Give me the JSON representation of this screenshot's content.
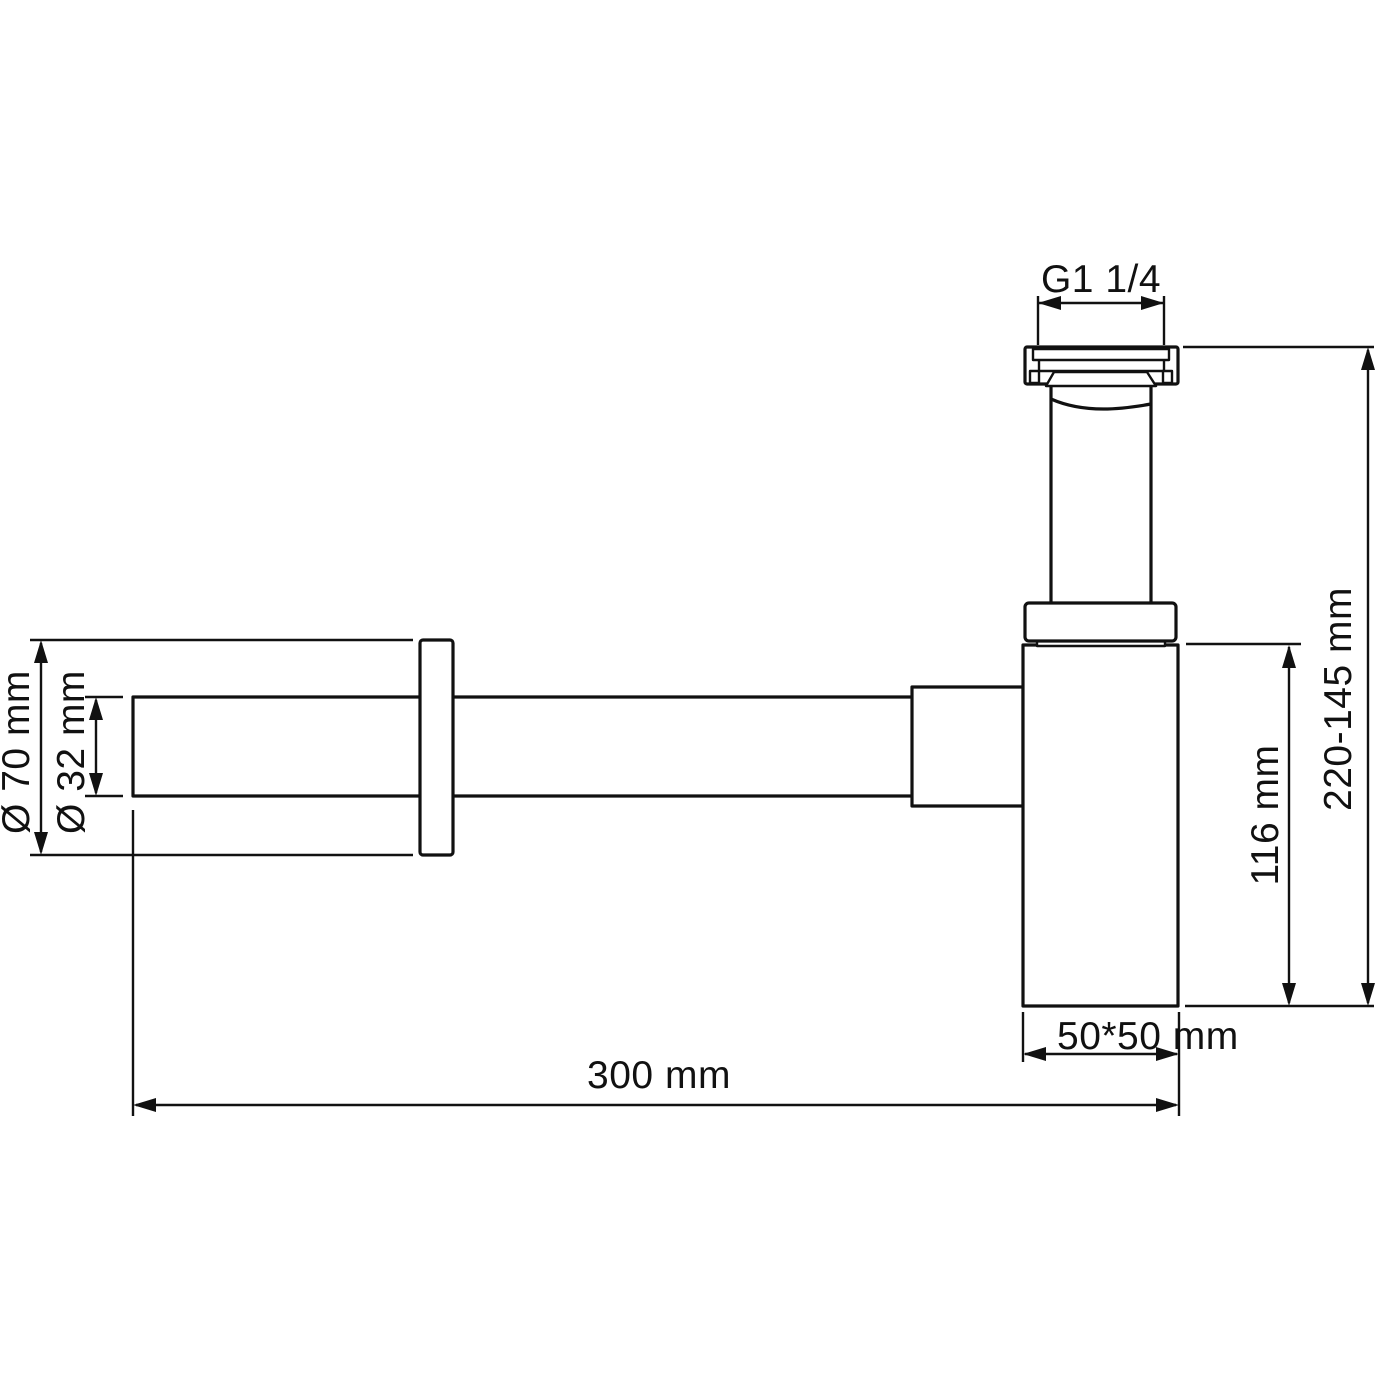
{
  "drawing": {
    "colors": {
      "line": "#111111",
      "background": "#ffffff"
    },
    "dimensions": {
      "thread": {
        "label": "G1 1/4"
      },
      "height_range": {
        "label": "220-145 mm"
      },
      "body_height": {
        "label": "116 mm"
      },
      "body_footprint": {
        "label": "50*50 mm"
      },
      "total_length": {
        "label": "300 mm"
      },
      "flange_diameter": {
        "label": "Ø 70 mm"
      },
      "pipe_diameter": {
        "label": "Ø 32 mm"
      }
    }
  }
}
